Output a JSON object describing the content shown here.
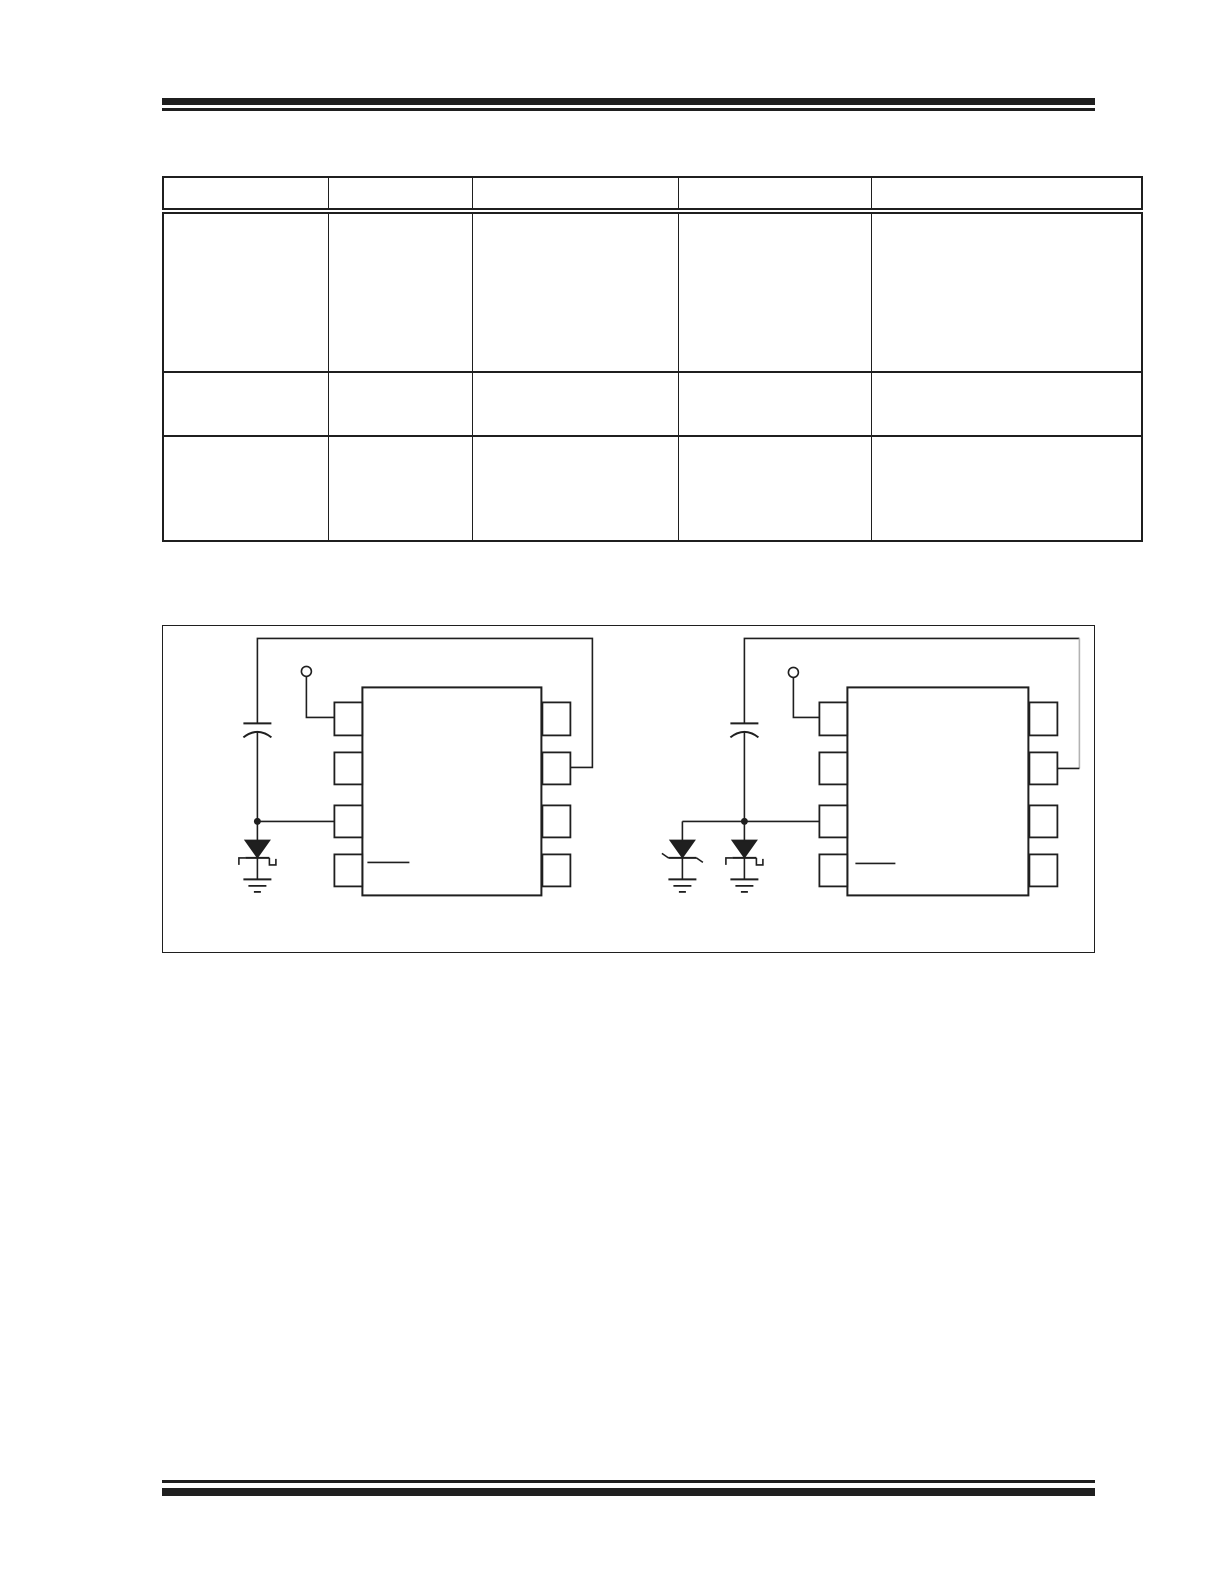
{
  "page": {
    "width": 1224,
    "height": 1584,
    "background": "#ffffff",
    "ink_color": "#1f1f1f",
    "muted_wire_color": "#b3b3b3"
  },
  "header_rule": {
    "label": ""
  },
  "table": {
    "header": [
      "",
      "",
      "",
      "",
      ""
    ],
    "rows": [
      [
        "",
        "",
        "",
        "",
        ""
      ],
      [
        "",
        "",
        "",
        "",
        ""
      ],
      [
        "",
        "",
        "",
        "",
        ""
      ]
    ]
  },
  "figure": {
    "caption": "",
    "circuits": [
      {
        "name": "left-application-circuit",
        "ic": "8-pin-package",
        "components": [
          "open-terminal",
          "capacitor",
          "schottky-diode",
          "ground"
        ]
      },
      {
        "name": "right-application-circuit",
        "ic": "8-pin-package",
        "components": [
          "open-terminal",
          "capacitor",
          "zener-diode",
          "schottky-diode",
          "ground"
        ]
      }
    ]
  },
  "footer_rule": {
    "label": ""
  }
}
